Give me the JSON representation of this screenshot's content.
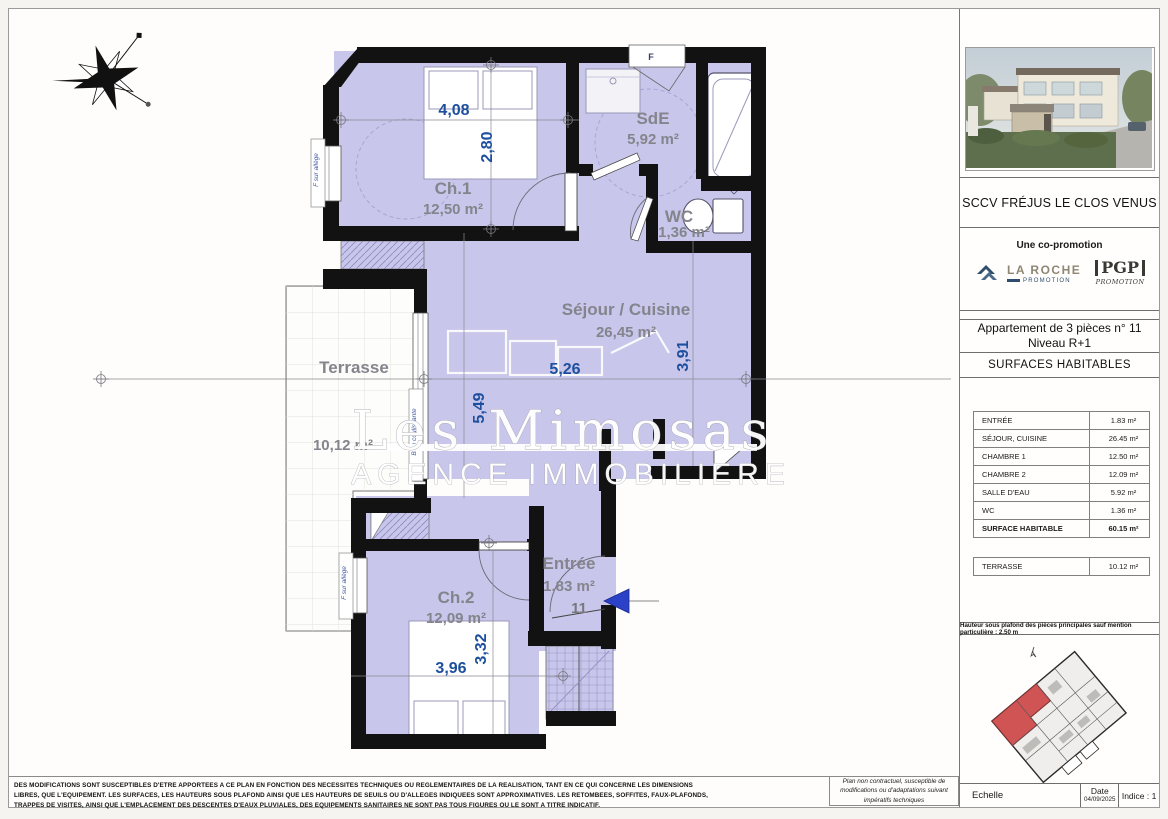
{
  "plan": {
    "rooms": [
      {
        "name": "Ch.1",
        "area": "12,50 m²"
      },
      {
        "name": "SdE",
        "area": "5,92 m²"
      },
      {
        "name": "WC",
        "area": "1,36 m²"
      },
      {
        "name": "Séjour / Cuisine",
        "area": "26,45 m²"
      },
      {
        "name": "Terrasse",
        "area": "10,12 m²"
      },
      {
        "name": "Ch.2",
        "area": "12,09 m²"
      },
      {
        "name": "Entrée",
        "area": "1,83 m²"
      }
    ],
    "dimensions": {
      "ch1_w": "4,08",
      "ch1_h": "2,80",
      "sejour_w": "5,26",
      "sejour_h": "5,49",
      "sejour_r": "3,91",
      "ch2_w": "3,96",
      "ch2_h": "3,32"
    },
    "unit_number": "11",
    "window_labels": {
      "f_sur_allege": "F sur allège",
      "baie": "Baie coulissante",
      "f": "F"
    },
    "watermark": {
      "line1": "Les Mimosas",
      "line2": "AGENCE IMMOBILIERE"
    }
  },
  "title_block": {
    "project": "SCCV FRÉJUS LE CLOS VENUS",
    "copromotion": "Une co-promotion",
    "logo_laroche": {
      "name": "LA ROCHE",
      "sub": "PROMOTION"
    },
    "logo_pgp": {
      "name": "PGP",
      "sub": "PROMOTION"
    },
    "apartment_line1": "Appartement de 3 pièces n° 11",
    "apartment_line2": "Niveau R+1",
    "surfaces_title": "SURFACES HABITABLES",
    "surface_rows": [
      {
        "label": "ENTRÉE",
        "value": "1.83 m²"
      },
      {
        "label": "SÉJOUR, CUISINE",
        "value": "26.45 m²"
      },
      {
        "label": "CHAMBRE 1",
        "value": "12.50 m²"
      },
      {
        "label": "CHAMBRE 2",
        "value": "12.09 m²"
      },
      {
        "label": "SALLE D'EAU",
        "value": "5.92 m²"
      },
      {
        "label": "WC",
        "value": "1.36 m²"
      }
    ],
    "total_row": {
      "label": "SURFACE HABITABLE",
      "value": "60.15 m²"
    },
    "terrace_row": {
      "label": "TERRASSE",
      "value": "10.12 m²"
    },
    "ceiling_note": "Hauteur sous plafond des pièces principales sauf mention particulière : 2.50 m",
    "plan_note": "Plan non contractuel, susceptible de modifications ou d'adaptations suivant impératifs techniques",
    "scale_label": "Echelle",
    "date_label": "Date",
    "date_value": "04/09/2025",
    "indice": "Indice : 1"
  },
  "disclaimer": "DES MODIFICATIONS SONT SUSCEPTIBLES D'ETRE APPORTEES A CE PLAN EN FONCTION DES NECESSITES TECHNIQUES OU REGLEMENTAIRES DE LA REALISATION, TANT EN CE QUI CONCERNE LES DIMENSIONS LIBRES, QUE L'EQUIPEMENT. LES SURFACES, LES HAUTEURS SOUS PLAFOND AINSI QUE LES HAUTEURS DE SEUILS OU D'ALLEGES INDIQUEES SONT APPROXIMATIVES. LES RETOMBEES, SOFFITES, FAUX-PLAFONDS, TRAPPES DE VISITES, AINSI QUE L'EMPLACEMENT DES DESCENTES D'EAUX PLUVIALES, DES EQUIPEMENTS SANITAIRES NE SONT PAS TOUS FIGURES OU LE SONT A TITRE INDICATIF.",
  "colors": {
    "room_fill": "#c8c6ea",
    "wall": "#121212",
    "dimension_text": "#1d4f9e",
    "room_label": "#84848c",
    "arrow_blue": "#2a41c8",
    "keyplan_highlight": "#d05454"
  }
}
